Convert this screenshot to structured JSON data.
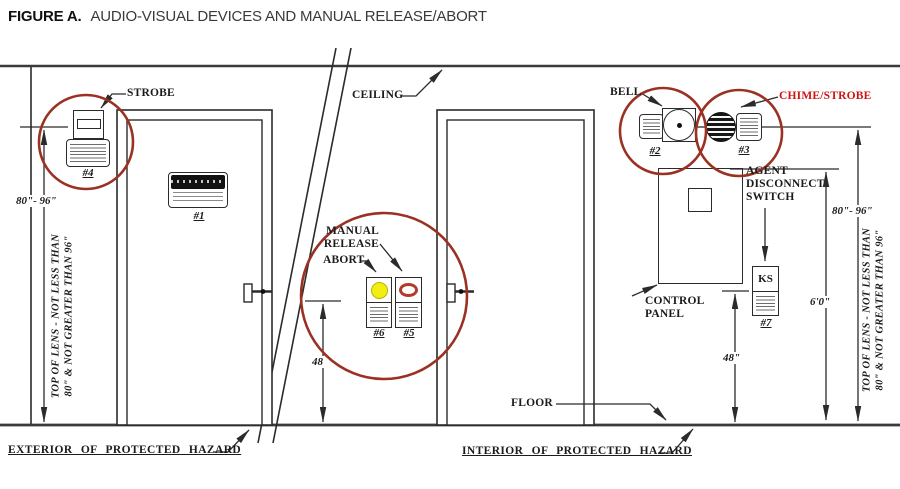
{
  "title": {
    "figure_label": "FIGURE A.",
    "text": "AUDIO-VISUAL DEVICES AND MANUAL RELEASE/ABORT"
  },
  "labels": {
    "ceiling": "CEILING",
    "floor": "FLOOR",
    "strobe": "STROBE",
    "bell": "BELL",
    "chime_strobe": "CHIME/STROBE",
    "manual_release": "MANUAL\nRELEASE",
    "abort": "ABORT",
    "control_panel": "CONTROL\nPANEL",
    "agent_disconnect_switch": "AGENT\nDISCONNECT\nSWITCH",
    "exterior_of_protected_hazard": "EXTERIOR OF PROTECTED HAZARD",
    "interior_of_protected_hazard": "INTERIOR OF PROTECTED HAZARD"
  },
  "devices": {
    "sign": "#1",
    "bell": "#2",
    "chime_strobe": "#3",
    "strobe": "#4",
    "manual_release": "#5",
    "abort": "#6",
    "key_switch": "#7",
    "key_switch_text": "KS"
  },
  "dimensions": {
    "lens_range_left": "80\"- 96\"",
    "lens_range_right": "80\"- 96\"",
    "lens_note_line1": "TOP OF LENS - NOT LESS THAN",
    "lens_note_line2": "80\" & NOT GREATER THAN 96\"",
    "release_height": "48",
    "switch_height": "48\"",
    "panel_top_height": "6'0\""
  },
  "colors": {
    "highlight_circle": "#9a3122",
    "chime_strobe_label": "#d01212",
    "abort_button_yellow": "#f2ee10",
    "release_ring_red": "#b23b2a",
    "linework": "#2b2b2b"
  }
}
